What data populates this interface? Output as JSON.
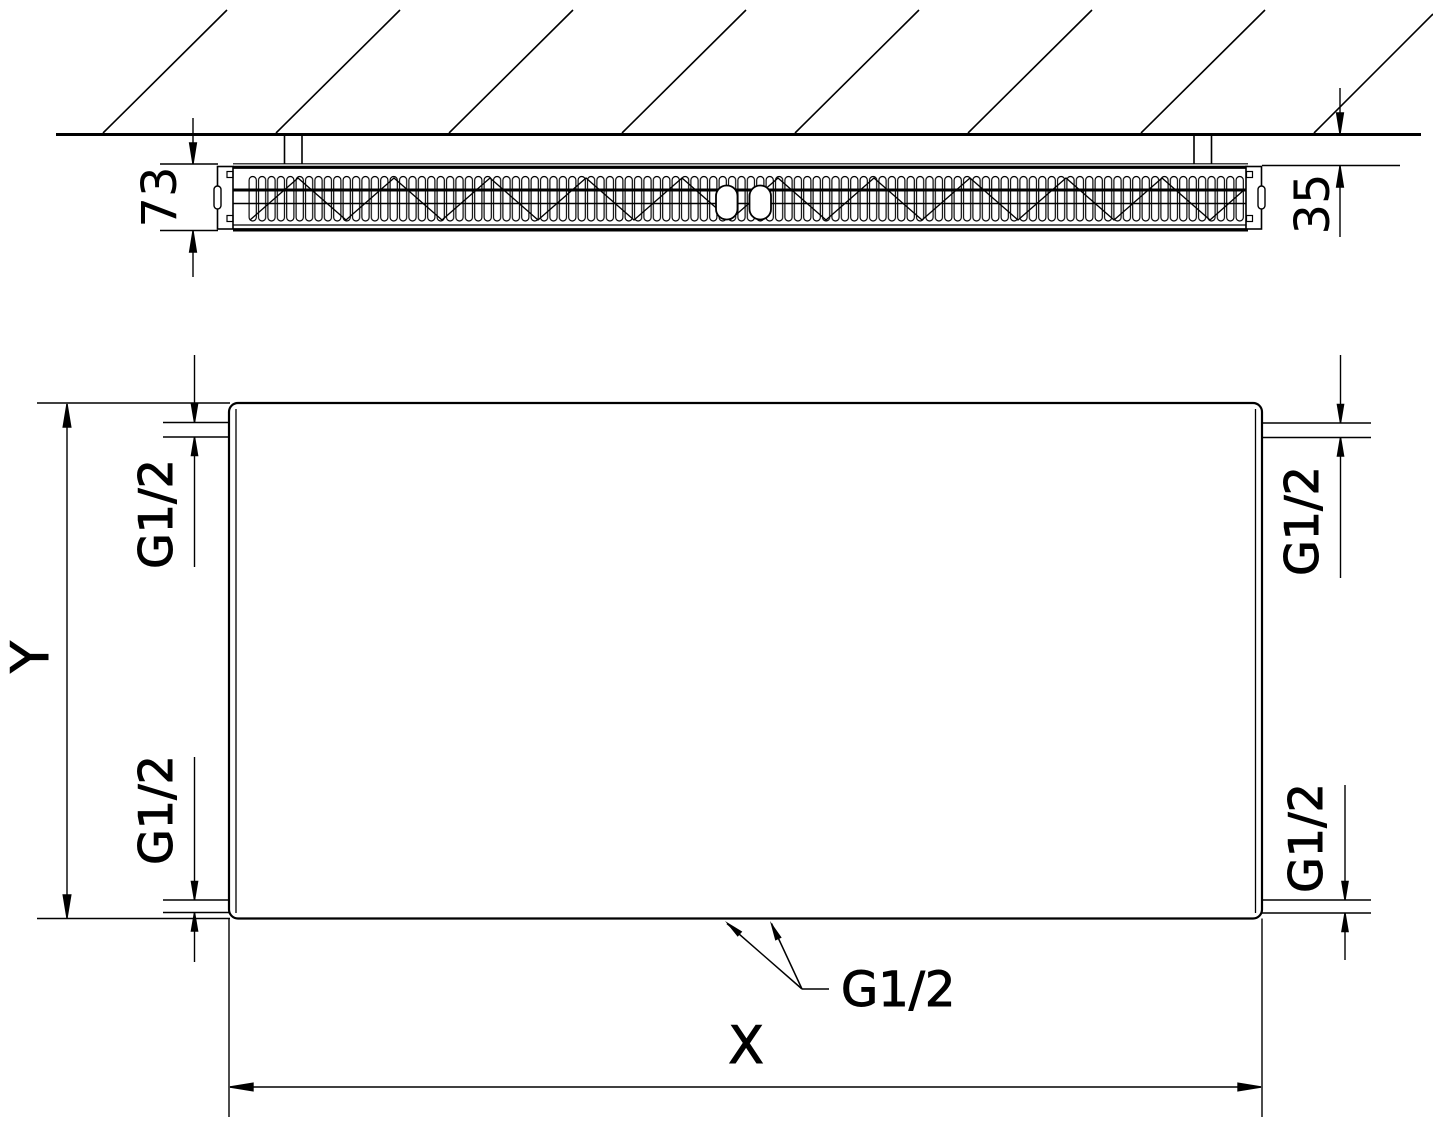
{
  "top_view": {
    "depth_dim": "73",
    "wall_distance_dim": "35"
  },
  "front_view": {
    "width_dim": "X",
    "height_dim": "Y",
    "connections": {
      "top_left": "G1/2",
      "bottom_left": "G1/2",
      "top_right": "G1/2",
      "bottom_right": "G1/2",
      "center": "G1/2"
    }
  },
  "colors": {
    "line": "#000000",
    "background": "#ffffff"
  }
}
